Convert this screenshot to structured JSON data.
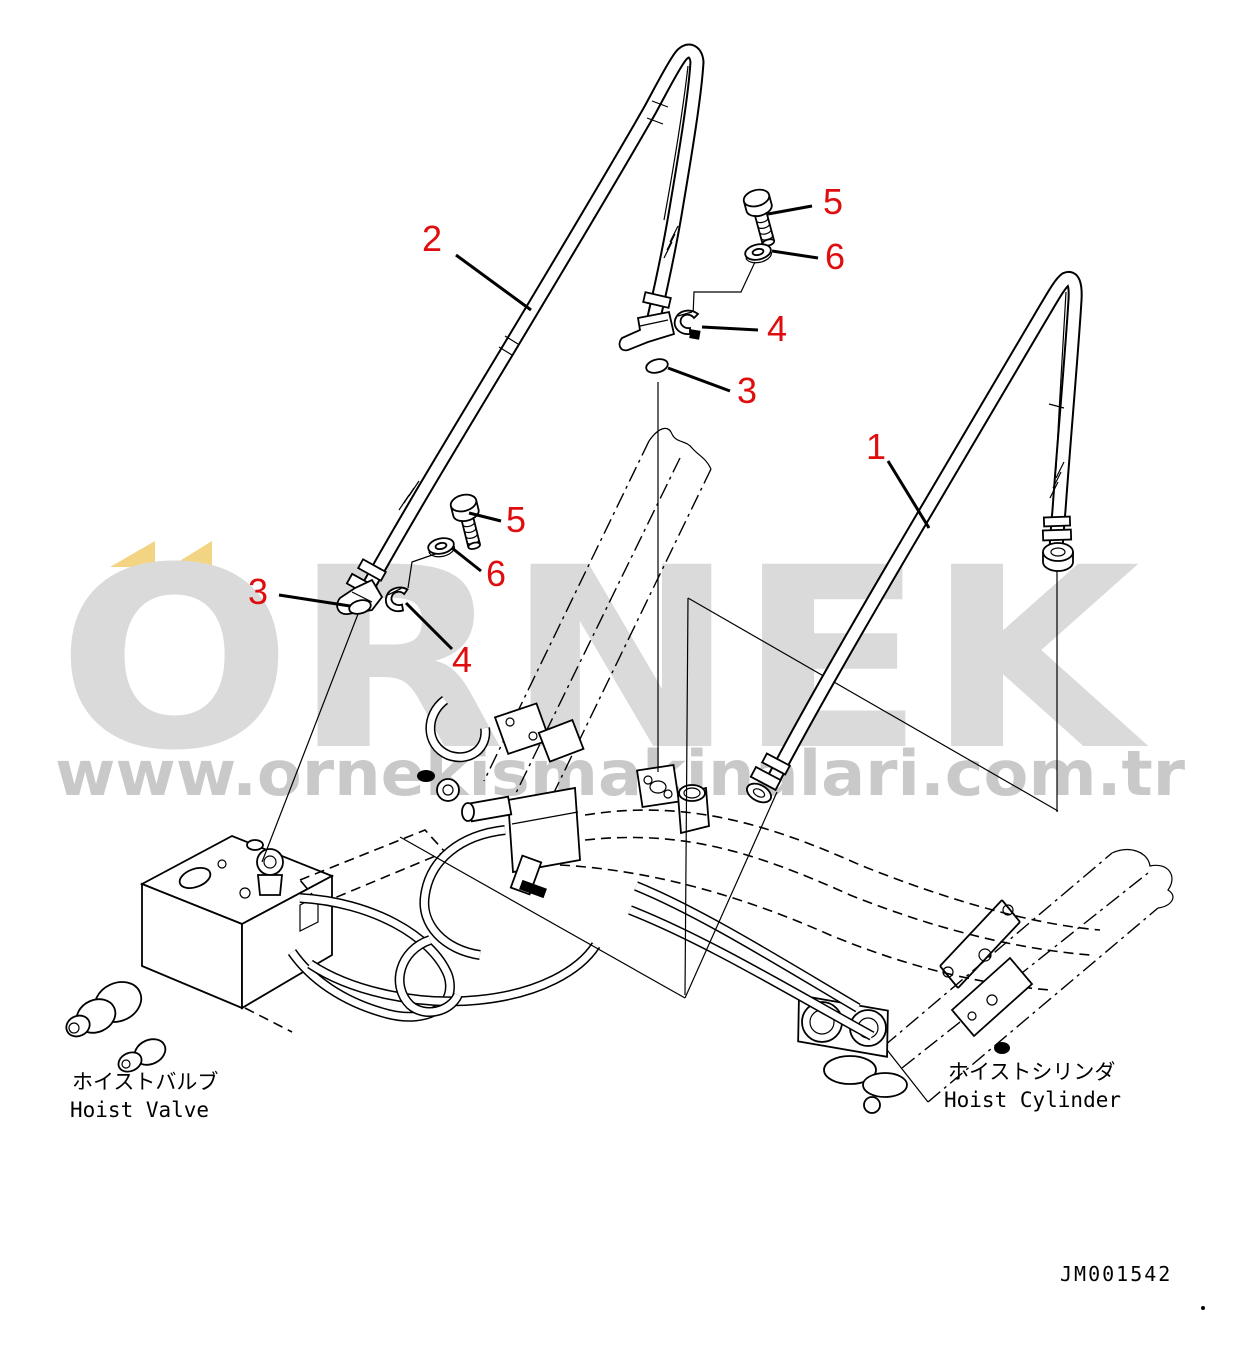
{
  "colors": {
    "callout_red": "#df0d0d",
    "line_black": "#000000",
    "watermark_gray": "#dadada",
    "watermark_url_gray": "#c9c9c9",
    "watermark_yellow": "#f3d483"
  },
  "watermark": {
    "brand": "ÖRNEK",
    "brand_letters": "ORNEK",
    "url": "www.ornekismakinalari.com.tr"
  },
  "part_labels": {
    "valve_jp": "ホイストバルブ",
    "valve_en": "Hoist Valve",
    "cylinder_jp": "ホイストシリンダ",
    "cylinder_en": "Hoist Cylinder"
  },
  "drawing_code": "JM001542",
  "callouts": [
    {
      "label": "2"
    },
    {
      "label": "5"
    },
    {
      "label": "6"
    },
    {
      "label": "4"
    },
    {
      "label": "3"
    },
    {
      "label": "1"
    },
    {
      "label": "5"
    },
    {
      "label": "6"
    },
    {
      "label": "3"
    },
    {
      "label": "4"
    }
  ]
}
